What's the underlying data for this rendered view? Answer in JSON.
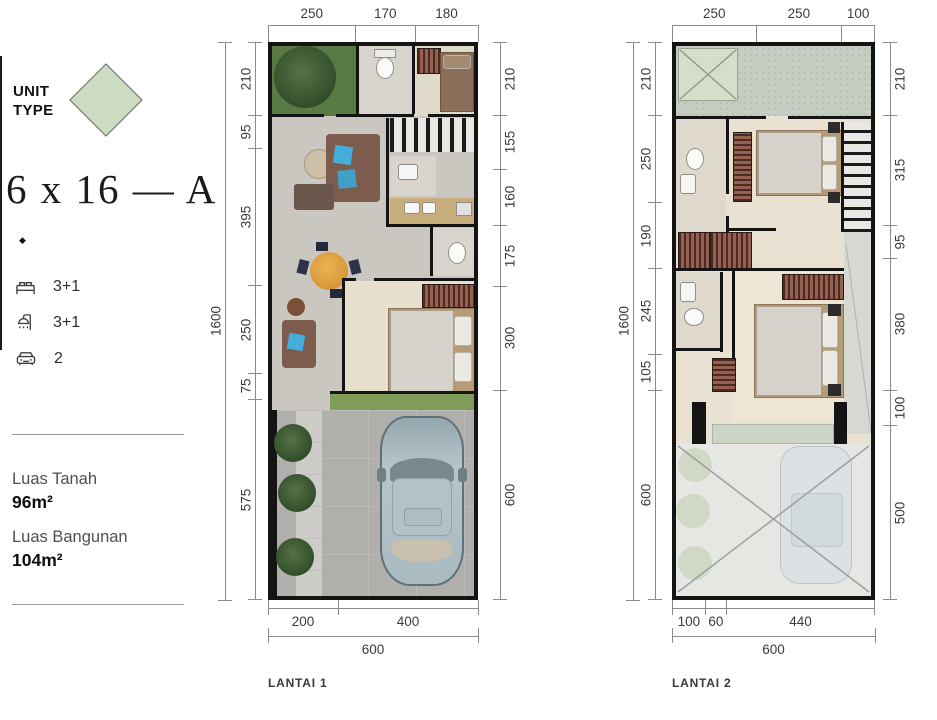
{
  "sidebar": {
    "unit_type": [
      "UNIT",
      "TYPE"
    ],
    "title": "6 x 16 — A",
    "bullet": "◆",
    "specs": [
      {
        "icon": "bed-icon",
        "value": "3+1"
      },
      {
        "icon": "shower-icon",
        "value": "3+1"
      },
      {
        "icon": "car-icon",
        "value": "2"
      }
    ],
    "land_label": "Luas Tanah",
    "land_value": "96m²",
    "building_label": "Luas Bangunan",
    "building_value": "104m²"
  },
  "plans": [
    {
      "name": "LANTAI 1",
      "dims_top": [
        "250",
        "170",
        "180"
      ],
      "dims_left_total": "1600",
      "dims_left": [
        "210",
        "95",
        "395",
        "250",
        "75",
        "575"
      ],
      "dims_right": [
        "210",
        "155",
        "160",
        "175",
        "300",
        "600"
      ],
      "dims_bottom": [
        "200",
        "400"
      ],
      "dims_bottom_total": "600"
    },
    {
      "name": "LANTAI 2",
      "dims_top": [
        "250",
        "250",
        "100"
      ],
      "dims_left_total": "1600",
      "dims_left": [
        "210",
        "250",
        "190",
        "245",
        "105",
        "600"
      ],
      "dims_right": [
        "210",
        "315",
        "95",
        "380",
        "100",
        "500"
      ],
      "dims_bottom": [
        "100",
        "60",
        "440"
      ],
      "dims_bottom_total": "600"
    }
  ],
  "colors": {
    "unit_type_accent": "#ccdcc0",
    "wall": "#141414",
    "dim_line": "#8b8b8b"
  }
}
